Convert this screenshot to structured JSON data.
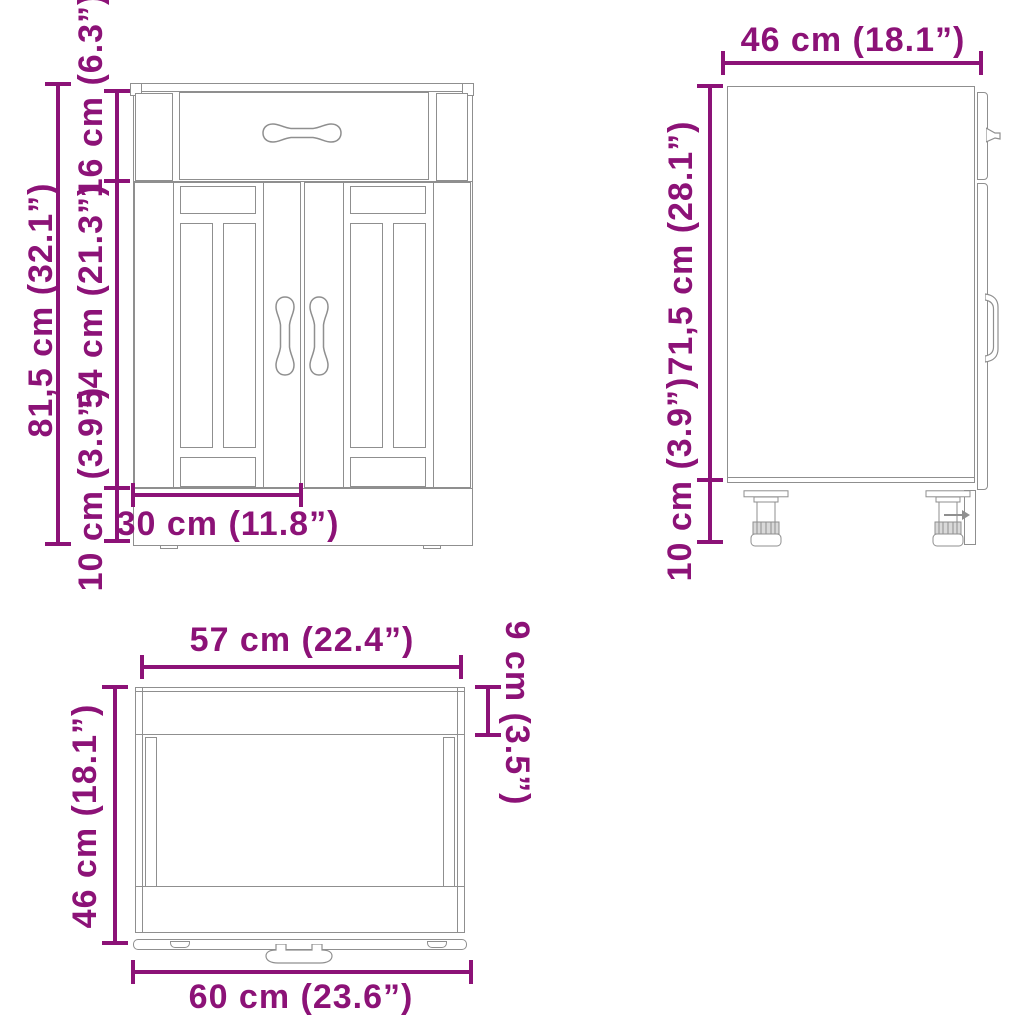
{
  "diagram": {
    "accent_color": "#8C1277",
    "line_color": "#8f8f8f"
  },
  "front_view": {
    "labels": {
      "total_height": "81,5 cm (32.1”)",
      "drawer_height": "16 cm (6.3”)",
      "doors_height": "54 cm (21.3”)",
      "plinth_height": "10 cm (3.9”)",
      "door_width": "30 cm (11.8”)"
    }
  },
  "side_view": {
    "labels": {
      "depth": "46 cm (18.1”)",
      "body_height": "71,5 cm (28.1”)",
      "leg_height": "10 cm (3.9”)"
    }
  },
  "top_view": {
    "labels": {
      "front_width": "57 cm (22.4”)",
      "top_depth": "9 cm (3.5”)",
      "depth": "46 cm (18.1”)",
      "total_width": "60 cm (23.6”)"
    }
  }
}
